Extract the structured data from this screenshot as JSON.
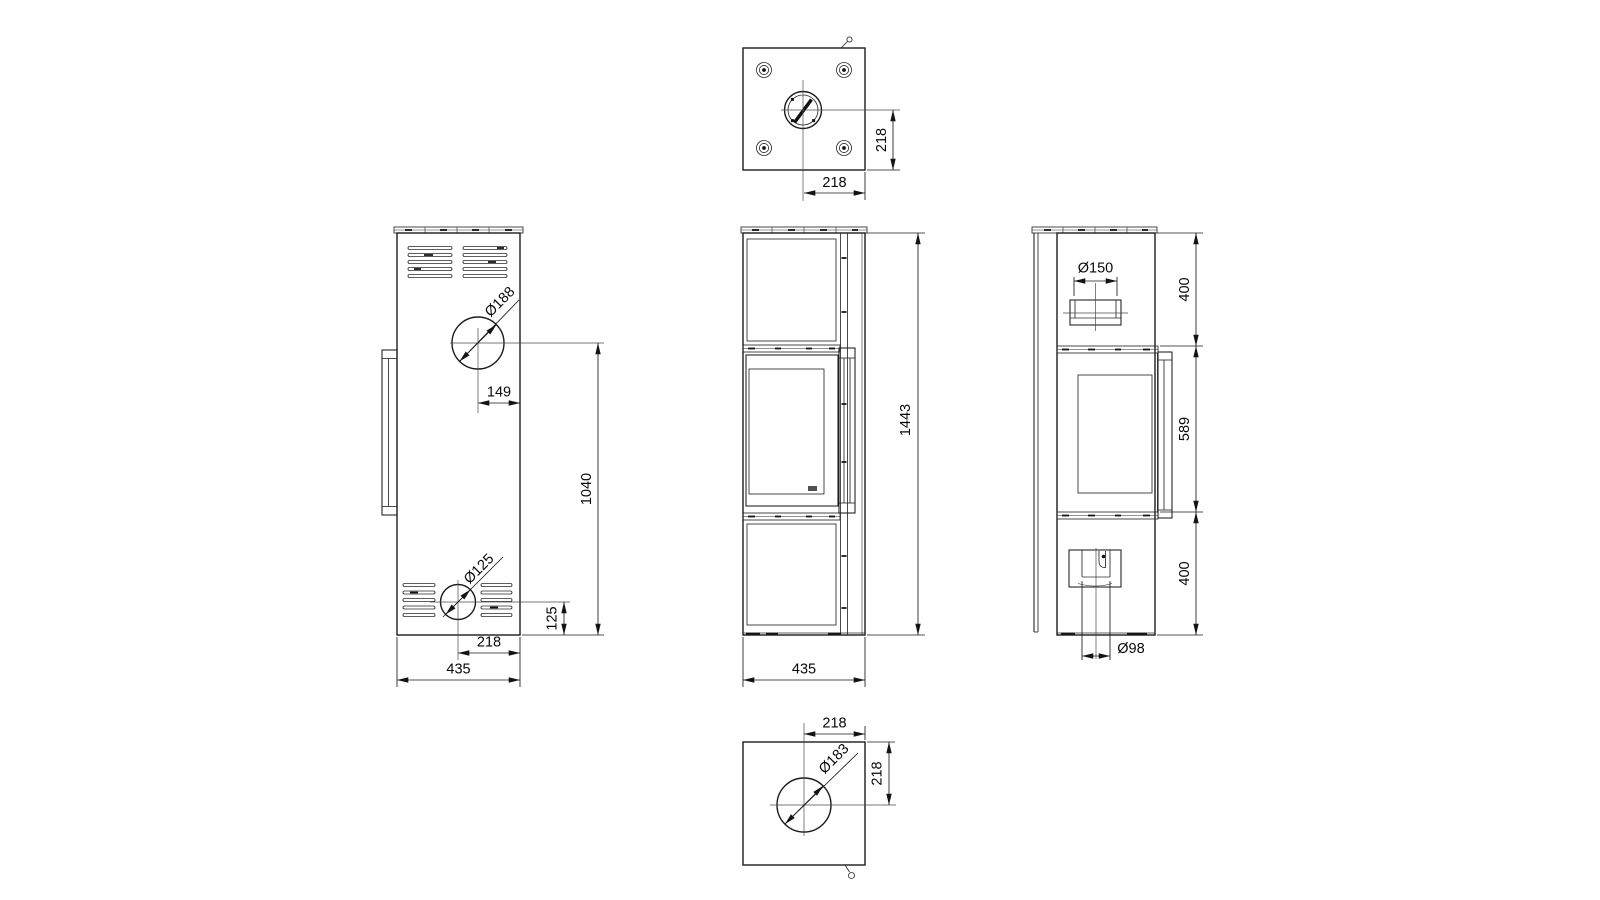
{
  "drawing": {
    "background_color": "#ffffff",
    "line_color": "#1c1c1c",
    "views": {
      "top_view": {
        "dim_side": "218",
        "dim_front": "218"
      },
      "back_view": {
        "flue_diameter": "Ø188",
        "flue_offset": "149",
        "flue_height": "1040",
        "inlet_diameter": "Ø125",
        "inlet_height": "125",
        "inlet_offset": "218",
        "width": "435"
      },
      "front_view": {
        "height": "1443",
        "width": "435"
      },
      "side_view": {
        "collar_diameter": "Ø150",
        "top_section": "400",
        "middle_section": "589",
        "bottom_section": "400",
        "air_inlet_diameter": "Ø98"
      },
      "bottom_view": {
        "dim_front": "218",
        "dim_side": "218",
        "opening_diameter": "Ø183"
      }
    }
  }
}
